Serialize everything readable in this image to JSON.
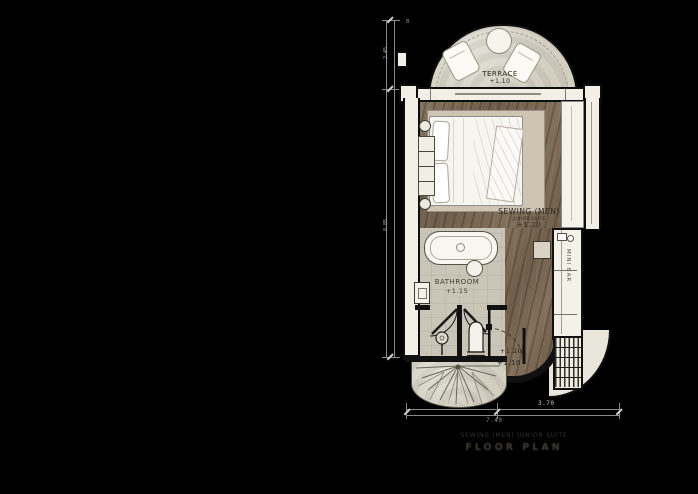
{
  "drawing": {
    "type": "architectural floor plan",
    "labels": {
      "terrace": "TERRACE",
      "terrace_level": "+1.10",
      "room": "SEWING (MEN)",
      "room_sub": "JUNIOR SUITE",
      "room_level": "+1.20",
      "bathroom": "BATHROOM",
      "bathroom_level": "+1.15",
      "minibar": "MINI BAR",
      "entry_level_upper": "+1.20",
      "entry_level_lower": "+1.10",
      "grid_marker": "B"
    },
    "dimensions": {
      "bottom_segments": [
        "3.70",
        "3.70"
      ],
      "bottom_total": "7.40",
      "left_segments": [
        "2.45",
        "8.85"
      ]
    },
    "caption": {
      "line1": "SEWING (MEN) JUNIOR SUITE",
      "line2": "FLOOR PLAN"
    },
    "icons": {
      "palm-plant-icon": "radiating-frond-lines",
      "round-table-icon": "circle",
      "lounge-chair-icon": "rounded-rect",
      "bathtub-icon": "oval-ring",
      "basin-icon": "circle",
      "toilet-icon": "arched-shape",
      "shower-icon": "circle-on-stem",
      "lamp-icon": "small-circle",
      "kettle-icon": "small-rects-circle",
      "stairs-icon": "hatched-rows"
    },
    "colors": {
      "background": "#000000",
      "wood_floor": "#7b6a57",
      "stone_floor": "#d3cfc1",
      "bath_floor": "#c9c5b7",
      "wall_fill": "#f2efe7",
      "wall_line": "#0d0d0d",
      "dim_line": "#8a8a8a",
      "label_ink": "#2e2a21"
    }
  }
}
